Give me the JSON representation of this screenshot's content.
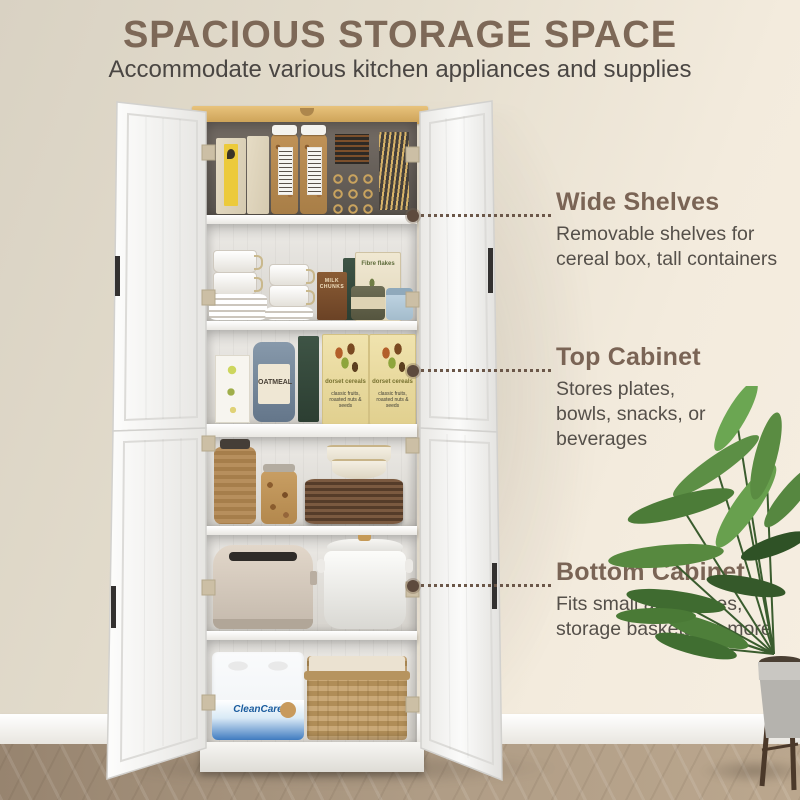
{
  "header": {
    "title": "SPACIOUS STORAGE SPACE",
    "subtitle": "Accommodate various kitchen appliances and supplies"
  },
  "callouts": [
    {
      "heading": "Wide Shelves",
      "line1": "Removable shelves for",
      "line2": "cereal box, tall containers"
    },
    {
      "heading": "Top Cabinet",
      "line1": "Stores plates,",
      "line2": "bowls, snacks, or beverages"
    },
    {
      "heading": "Bottom Cabinet",
      "line1": "Fits small appliances,",
      "line2": "storage baskets, or more"
    }
  ],
  "product_labels": {
    "paper_towels": "CleanCare",
    "oatmeal_tin": "OATMEAL",
    "cereal_name": "dorset cereals",
    "cereal_desc": "classic fruits, roasted nuts & seeds",
    "fibre_box": "Fibre flakes",
    "snack_box": "MILK CHUNKS"
  },
  "colors": {
    "heading_brown": "#7a6455",
    "body_text": "#55504a",
    "callout_dot": "#5d4a3d",
    "wood_top": "#d9b269",
    "wall": "#e8e1d2",
    "floor": "#ab9780",
    "door_white": "#f4f3f1"
  }
}
